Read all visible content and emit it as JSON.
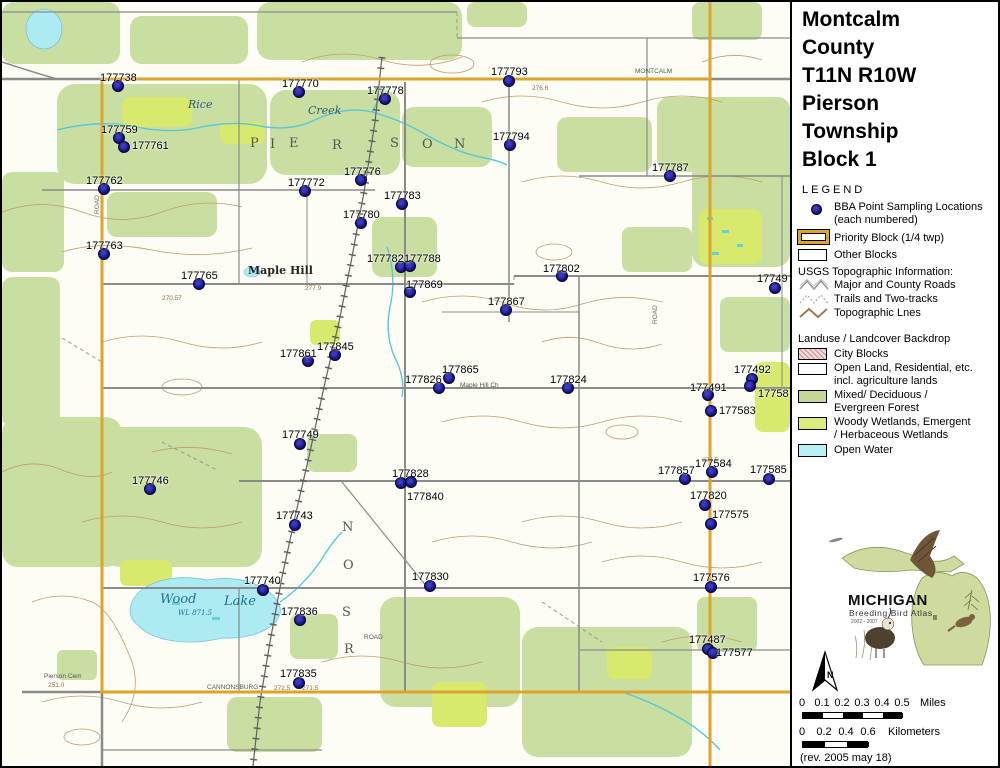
{
  "title": {
    "lines": [
      "Montcalm",
      "County",
      "T11N R10W",
      "Pierson",
      "Township",
      "Block 1"
    ]
  },
  "legend": {
    "heading": "LEGEND",
    "bba_label_1": "BBA Point Sampling Locations",
    "bba_label_2": "(each numbered)",
    "priority_label": "Priority Block (1/4 twp)",
    "other_label": "Other Blocks",
    "usgs_heading": "USGS Topographic Information:",
    "usgs_items": [
      {
        "name": "major-county-roads",
        "label": "Major and County Roads"
      },
      {
        "name": "trails-two-tracks",
        "label": "Trails and Two-tracks"
      },
      {
        "name": "topographic-lines",
        "label": "Topographic Lnes"
      }
    ],
    "landuse_heading": "Landuse / Landcover Backdrop",
    "landuse_items": [
      {
        "name": "city-blocks",
        "label1": "City Blocks",
        "label2": "",
        "color": "#f3dada"
      },
      {
        "name": "open-land",
        "label1": "Open Land, Residential, etc.",
        "label2": "incl. agriculture lands",
        "color": "#ffffff"
      },
      {
        "name": "mixed-forest",
        "label1": "Mixed/ Deciduous /",
        "label2": "Evergreen Forest",
        "color": "#c6d795"
      },
      {
        "name": "woody-wetlands",
        "label1": "Woody Wetlands, Emergent",
        "label2": "/ Herbaceous Wetlands",
        "color": "#daee7c"
      },
      {
        "name": "open-water",
        "label1": "Open Water",
        "label2": "",
        "color": "#b9f0f6"
      }
    ]
  },
  "logo": {
    "name": "MICHIGAN",
    "subtitle": "Breeding Bird Atlas",
    "years": "2002 - 2007",
    "numeral": "II"
  },
  "north_label": "N",
  "scale_miles": {
    "ticks": [
      "0",
      "0.1",
      "0.2",
      "0.3",
      "0.4",
      "0.5"
    ],
    "unit": "Miles"
  },
  "scale_km": {
    "ticks": [
      "0",
      "0.2",
      "0.4",
      "0.6"
    ],
    "unit": "Kilometers"
  },
  "revision": "(rev. 2005 may 18)",
  "map": {
    "colors": {
      "forest": "#c9dfa2",
      "wetland": "#d9e96e",
      "water": "#aeeaf2",
      "contour": "#c29a6a",
      "road": "#8a8a8a",
      "priority_border": "#dda32a",
      "sample_point": "#15137f"
    },
    "points": [
      {
        "id": "177738",
        "x": 116,
        "y": 84,
        "lx": 98,
        "ly": 70
      },
      {
        "id": "177770",
        "x": 297,
        "y": 90,
        "lx": 280,
        "ly": 76
      },
      {
        "id": "177759",
        "x": 117,
        "y": 136,
        "lx": 99,
        "ly": 122
      },
      {
        "id": "177761",
        "x": 122,
        "y": 145,
        "lx": 130,
        "ly": 138
      },
      {
        "id": "177762",
        "x": 102,
        "y": 187,
        "lx": 84,
        "ly": 173
      },
      {
        "id": "177763",
        "x": 102,
        "y": 252,
        "lx": 84,
        "ly": 238
      },
      {
        "id": "177772",
        "x": 303,
        "y": 189,
        "lx": 286,
        "ly": 175
      },
      {
        "id": "177776",
        "x": 359,
        "y": 178,
        "lx": 342,
        "ly": 164
      },
      {
        "id": "177778",
        "x": 383,
        "y": 97,
        "lx": 365,
        "ly": 83
      },
      {
        "id": "177780",
        "x": 359,
        "y": 221,
        "lx": 341,
        "ly": 207
      },
      {
        "id": "177783",
        "x": 400,
        "y": 202,
        "lx": 382,
        "ly": 188
      },
      {
        "id": "177793",
        "x": 507,
        "y": 79,
        "lx": 489,
        "ly": 64
      },
      {
        "id": "177794",
        "x": 508,
        "y": 143,
        "lx": 491,
        "ly": 129
      },
      {
        "id": "177787",
        "x": 668,
        "y": 174,
        "lx": 650,
        "ly": 160
      },
      {
        "id": "177765",
        "x": 197,
        "y": 282,
        "lx": 179,
        "ly": 268
      },
      {
        "id": "177782",
        "x": 399,
        "y": 265,
        "lx": 365,
        "ly": 251
      },
      {
        "id": "177788",
        "x": 408,
        "y": 264,
        "lx": 402,
        "ly": 251
      },
      {
        "id": "177802",
        "x": 560,
        "y": 274,
        "lx": 541,
        "ly": 261
      },
      {
        "id": "177869",
        "x": 408,
        "y": 290,
        "lx": 404,
        "ly": 277
      },
      {
        "id": "177867",
        "x": 504,
        "y": 308,
        "lx": 486,
        "ly": 294
      },
      {
        "id": "17749",
        "x": 773,
        "y": 286,
        "lx": 755,
        "ly": 271
      },
      {
        "id": "177845",
        "x": 333,
        "y": 353,
        "lx": 315,
        "ly": 339
      },
      {
        "id": "177861",
        "x": 306,
        "y": 359,
        "lx": 278,
        "ly": 346
      },
      {
        "id": "177865",
        "x": 447,
        "y": 376,
        "lx": 440,
        "ly": 362
      },
      {
        "id": "177826",
        "x": 437,
        "y": 386,
        "lx": 403,
        "ly": 372
      },
      {
        "id": "177824",
        "x": 566,
        "y": 386,
        "lx": 548,
        "ly": 372
      },
      {
        "id": "177492",
        "x": 750,
        "y": 377,
        "lx": 732,
        "ly": 362
      },
      {
        "id": "177491",
        "x": 706,
        "y": 393,
        "lx": 688,
        "ly": 380
      },
      {
        "id": "17758",
        "x": 748,
        "y": 384,
        "lx": 756,
        "ly": 386
      },
      {
        "id": "177583",
        "x": 709,
        "y": 409,
        "lx": 717,
        "ly": 403
      },
      {
        "id": "177584",
        "x": 710,
        "y": 470,
        "lx": 693,
        "ly": 456
      },
      {
        "id": "177857",
        "x": 683,
        "y": 477,
        "lx": 656,
        "ly": 463
      },
      {
        "id": "177585",
        "x": 767,
        "y": 477,
        "lx": 748,
        "ly": 462
      },
      {
        "id": "177820",
        "x": 703,
        "y": 503,
        "lx": 688,
        "ly": 488
      },
      {
        "id": "177575",
        "x": 709,
        "y": 522,
        "lx": 710,
        "ly": 507
      },
      {
        "id": "177576",
        "x": 709,
        "y": 585,
        "lx": 691,
        "ly": 570
      },
      {
        "id": "177487",
        "x": 706,
        "y": 647,
        "lx": 687,
        "ly": 632
      },
      {
        "id": "177577",
        "x": 711,
        "y": 651,
        "lx": 714,
        "ly": 645
      },
      {
        "id": "177749",
        "x": 298,
        "y": 442,
        "lx": 280,
        "ly": 427
      },
      {
        "id": "177746",
        "x": 148,
        "y": 487,
        "lx": 130,
        "ly": 473
      },
      {
        "id": "177743",
        "x": 293,
        "y": 523,
        "lx": 274,
        "ly": 508
      },
      {
        "id": "177740",
        "x": 261,
        "y": 588,
        "lx": 242,
        "ly": 573
      },
      {
        "id": "177828",
        "x": 399,
        "y": 481,
        "lx": 390,
        "ly": 466
      },
      {
        "id": "177840",
        "x": 409,
        "y": 480,
        "lx": 405,
        "ly": 489
      },
      {
        "id": "177830",
        "x": 428,
        "y": 584,
        "lx": 410,
        "ly": 569
      },
      {
        "id": "177836",
        "x": 298,
        "y": 618,
        "lx": 279,
        "ly": 604
      },
      {
        "id": "177835",
        "x": 297,
        "y": 681,
        "lx": 278,
        "ly": 666
      }
    ],
    "place_labels": [
      {
        "t": "Rice",
        "x": 186,
        "y": 96,
        "c": "stream"
      },
      {
        "t": "Creek",
        "x": 306,
        "y": 102,
        "c": "stream"
      },
      {
        "t": "P",
        "x": 248,
        "y": 134,
        "c": "twp"
      },
      {
        "t": "I",
        "x": 268,
        "y": 135,
        "c": "twp"
      },
      {
        "t": "E",
        "x": 287,
        "y": 134,
        "c": "twp"
      },
      {
        "t": "R",
        "x": 330,
        "y": 136,
        "c": "twp"
      },
      {
        "t": "S",
        "x": 388,
        "y": 134,
        "c": "twp"
      },
      {
        "t": "O",
        "x": 420,
        "y": 135,
        "c": "twp"
      },
      {
        "t": "N",
        "x": 452,
        "y": 135,
        "c": "twp"
      },
      {
        "t": "N",
        "x": 340,
        "y": 518,
        "c": "twp"
      },
      {
        "t": "O",
        "x": 341,
        "y": 556,
        "c": "twp"
      },
      {
        "t": "S",
        "x": 340,
        "y": 603,
        "c": "twp"
      },
      {
        "t": "R",
        "x": 342,
        "y": 640,
        "c": "twp"
      },
      {
        "t": "Maple Hill",
        "x": 246,
        "y": 262,
        "c": "place"
      },
      {
        "t": "Wood",
        "x": 158,
        "y": 590,
        "c": "lake"
      },
      {
        "t": "Lake",
        "x": 222,
        "y": 592,
        "c": "lake"
      },
      {
        "t": "WL 871.5",
        "x": 176,
        "y": 607,
        "c": "laketiny"
      },
      {
        "t": "Maple Hill Ch",
        "x": 458,
        "y": 380,
        "c": "tiny"
      },
      {
        "t": "Pierson Cem",
        "x": 42,
        "y": 671,
        "c": "tiny"
      },
      {
        "t": "251.0",
        "x": 46,
        "y": 680,
        "c": "tinybrown"
      },
      {
        "t": "MONTCALM",
        "x": 633,
        "y": 66,
        "c": "tiny"
      },
      {
        "t": "CANNONSBURG",
        "x": 205,
        "y": 682,
        "c": "tiny"
      },
      {
        "t": "272.5",
        "x": 272,
        "y": 683,
        "c": "tinybrown"
      },
      {
        "t": "271.5",
        "x": 300,
        "y": 683,
        "c": "tinybrown"
      },
      {
        "t": "277.9",
        "x": 303,
        "y": 283,
        "c": "tinybrown"
      },
      {
        "t": "270.57",
        "x": 160,
        "y": 293,
        "c": "tinybrown"
      },
      {
        "t": "276.6",
        "x": 530,
        "y": 83,
        "c": "tinybrown"
      },
      {
        "t": "274.5",
        "x": 700,
        "y": 455,
        "c": "tinybrown"
      },
      {
        "t": "ROAD",
        "x": 92,
        "y": 212,
        "c": "vroad"
      },
      {
        "t": "ROAD",
        "x": 650,
        "y": 322,
        "c": "vroad"
      },
      {
        "t": "ROAD",
        "x": 362,
        "y": 632,
        "c": "tiny"
      }
    ]
  }
}
